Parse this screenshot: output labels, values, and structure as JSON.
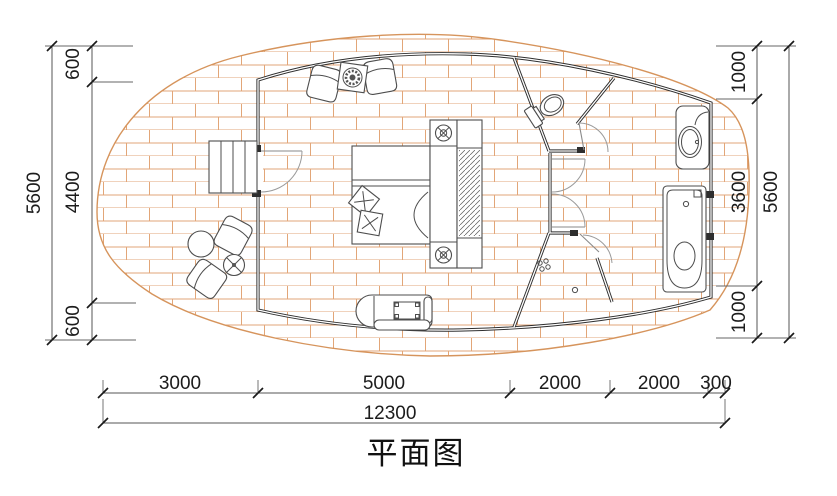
{
  "title": "平面图",
  "colors": {
    "brick_line": "#e2a678",
    "deck_edge": "#d6945c",
    "wall": "#2e2e2e",
    "dimension_line": "#555555",
    "text": "#1c1c1c"
  },
  "dimensions": {
    "left": {
      "total": "5600",
      "segments": [
        "600",
        "4400",
        "600"
      ]
    },
    "right": {
      "total": "5600",
      "segments": [
        "1000",
        "3600",
        "1000"
      ]
    },
    "bottom": {
      "segments": [
        "3000",
        "5000",
        "2000",
        "2000",
        "300"
      ],
      "total": "12300"
    }
  },
  "furniture": [
    "entry-steps",
    "entry-door",
    "lounge-chairs",
    "stove-table",
    "double-bed",
    "nightstands-with-lamps",
    "wardrobe",
    "toilet",
    "shower-room",
    "wash-basin",
    "bathtub",
    "tv-cabinet",
    "outdoor-chairs",
    "outdoor-table",
    "outdoor-stool"
  ]
}
